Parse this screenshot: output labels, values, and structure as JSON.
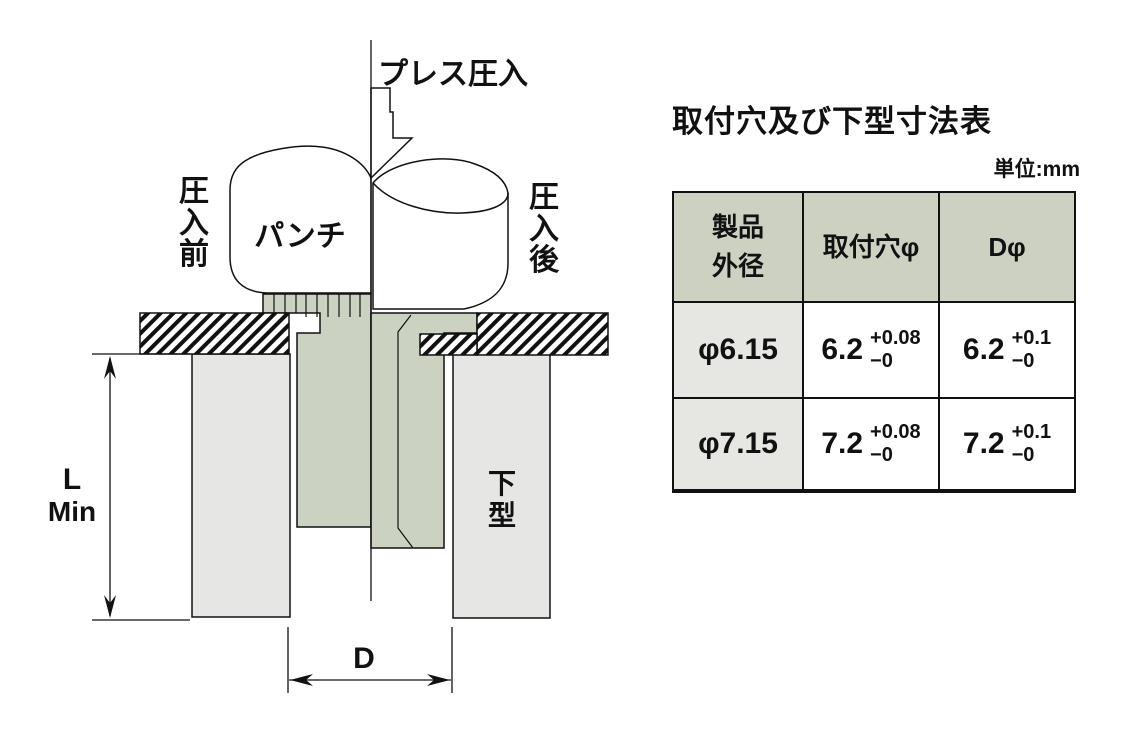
{
  "diagram": {
    "press_arrow_label": "プレス圧入",
    "punch_label": "パンチ",
    "before_label_chars": [
      "圧",
      "入",
      "前"
    ],
    "after_label_chars": [
      "圧",
      "入",
      "後"
    ],
    "lower_die_chars": [
      "下",
      "型"
    ],
    "dim_l_line1": "L",
    "dim_l_line2": "Min",
    "dim_d_label": "D"
  },
  "table": {
    "title": "取付穴及び下型寸法表",
    "unit_note": "単位:mm",
    "headers": {
      "col1_line1": "製品",
      "col1_line2": "外径",
      "col2": "取付穴φ",
      "col3": "Dφ"
    },
    "rows": [
      {
        "outer_dia": "φ6.15",
        "hole": {
          "value": "6.2",
          "plus": "+0.08",
          "minus": "−0"
        },
        "d": {
          "value": "6.2",
          "plus": "+0.1",
          "minus": "−0"
        }
      },
      {
        "outer_dia": "φ7.15",
        "hole": {
          "value": "7.2",
          "plus": "+0.08",
          "minus": "−0"
        },
        "d": {
          "value": "7.2",
          "plus": "+0.1",
          "minus": "−0"
        }
      }
    ]
  },
  "colors": {
    "part_green": "#ccd2c2",
    "header_bg": "#ccd1c1",
    "row_label_bg": "#e6e6e2",
    "die_gray": "#e6e6e4",
    "line": "#111111"
  }
}
